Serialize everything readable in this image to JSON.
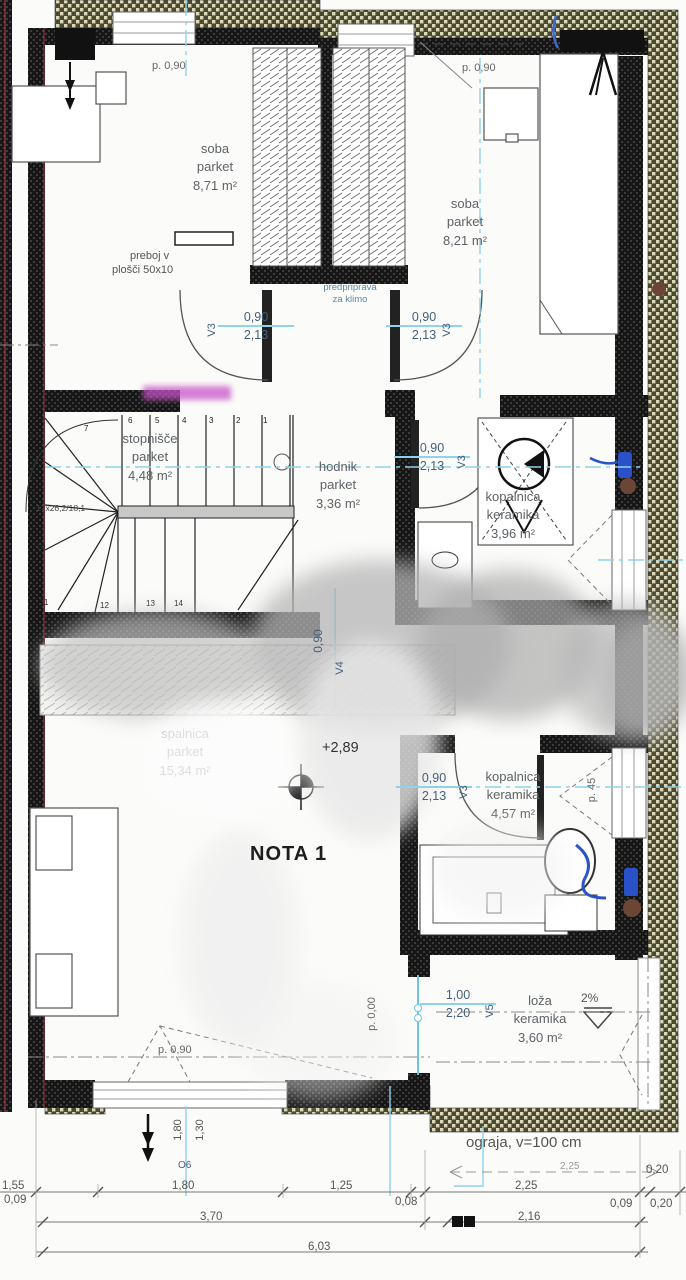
{
  "plan": {
    "unit_label": "NOTA 1",
    "elevation": "+2,89",
    "slope": "2%",
    "railing": "ograja, v=100 cm",
    "klima_1": "predpriprava",
    "klima_2": "za klimo",
    "preboj_1": "preboj v",
    "preboj_2": "plošči 50x10",
    "stair_spec": "17x26,2/18,1"
  },
  "rooms": {
    "soba1": {
      "name": "soba",
      "finish": "parket",
      "area": "8,71 m²"
    },
    "soba2": {
      "name": "soba",
      "finish": "parket",
      "area": "8,21 m²"
    },
    "stopnisce": {
      "name": "stopnišče",
      "finish": "parket",
      "area": "4,48 m²"
    },
    "hodnik": {
      "name": "hodnik",
      "finish": "parket",
      "area": "3,36 m²"
    },
    "kopalnica1": {
      "name": "kopalnica",
      "finish": "keramika",
      "area": "3,96 m²"
    },
    "spalnica": {
      "name": "spalnica",
      "finish": "parket",
      "area": "15,34 m²"
    },
    "kopalnica2": {
      "name": "kopalnica",
      "finish": "keramika",
      "area": "4,57 m²"
    },
    "loza": {
      "name": "loža",
      "finish": "keramika",
      "area": "3,60 m²"
    }
  },
  "doors": {
    "d1": {
      "code": "V3",
      "w": "0,90",
      "h": "2,13"
    },
    "d2": {
      "code": "V3",
      "w": "0,90",
      "h": "2,13"
    },
    "d3": {
      "code": "V3",
      "w": "0,90",
      "h": "2,13"
    },
    "d4": {
      "code": "V3",
      "w": "0,90",
      "h": "2,13"
    },
    "d5": {
      "code": "V5",
      "w": "1,00",
      "h": "2,20"
    },
    "d6": {
      "code": "V4",
      "w": "0,90"
    }
  },
  "window": {
    "code": "O6",
    "w": "1,80",
    "h": "1,30"
  },
  "parapets": {
    "top_left": "p. 0,90",
    "top_right": "p. 0,90",
    "bottom": "p. 0,90",
    "loza": "p. 0,00",
    "kop2": "p. 45"
  },
  "dims": {
    "a": "1,55",
    "a2": "0,09",
    "b": "1,80",
    "c": "1,25",
    "d": "0,08",
    "e": "2,25",
    "f": "0,09",
    "g": "0,20",
    "h": "0,20",
    "total1": "3,70",
    "total1b": "2,16",
    "total2": "6,03",
    "railing": "2,25"
  },
  "stairs": {
    "numbers": [
      "1",
      "2",
      "3",
      "4",
      "5",
      "6",
      "7",
      "8",
      "9",
      "10",
      "11",
      "12",
      "13",
      "14"
    ]
  },
  "colors": {
    "axis_blue": "#8fd2ec",
    "dim_text": "#44607a",
    "wall": "#161616",
    "insulation_dark": "#4a4a33",
    "insulation_light": "#ddd8b8",
    "section_red": "#b23642",
    "fixture_blue": "#2a52c8"
  }
}
